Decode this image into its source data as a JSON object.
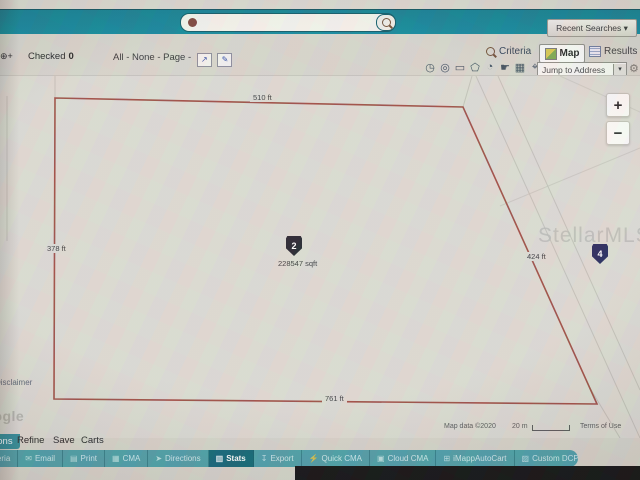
{
  "topbar": {
    "recent_searches_label": "Recent Searches ▾"
  },
  "search": {
    "value": ""
  },
  "toolbar": {
    "left_fragment": "⊕+",
    "checked_label": "Checked",
    "checked_count": "0",
    "select_links": "All - None - Page -",
    "select_icons": [
      "↗",
      "✎"
    ],
    "criteria_label": "Criteria",
    "map_label": "Map",
    "results_label": "Results"
  },
  "map_tools": {
    "glyphs": [
      "◷",
      "◎",
      "▭",
      "⬠",
      "◔",
      "☛",
      "▦",
      "⌖"
    ],
    "jump_label": "Jump to Address"
  },
  "map_type": {
    "fragment": "p"
  },
  "ui": {
    "caret_down": "▾",
    "gear": "⚙"
  },
  "map": {
    "watermark": "StellarMLS",
    "zoom_in": "+",
    "zoom_out": "−",
    "parcel": {
      "top_length": "510 ft",
      "left_length": "378 ft",
      "right_length": "424 ft",
      "bottom_length": "761 ft",
      "marker_number": "2",
      "area": "228547 sqft",
      "marker2_number": "4",
      "outline_color": "#9c4a40"
    },
    "disclaimer": "Disclaimer",
    "logo_partial": "Google",
    "attribution": "Map data ©2020",
    "scale_label": "20 m",
    "terms": "Terms of Use"
  },
  "bottom_tabs": {
    "actions": "Actions",
    "refine": "Refine",
    "save": "Save",
    "carts": "Carts"
  },
  "taskbar": {
    "accent_color": "#4a9da6",
    "active_color": "#0d6273",
    "buttons": [
      {
        "label": "Criteria",
        "icon": "⌕"
      },
      {
        "label": "Email",
        "icon": "✉"
      },
      {
        "label": "Print",
        "icon": "▤"
      },
      {
        "label": "CMA",
        "icon": "▦"
      },
      {
        "label": "Directions",
        "icon": "➤"
      },
      {
        "label": "Stats",
        "icon": "▥"
      },
      {
        "label": "Export",
        "icon": "↧"
      },
      {
        "label": "Quick CMA",
        "icon": "⚡"
      },
      {
        "label": "Cloud CMA",
        "icon": "▣"
      },
      {
        "label": "iMappAutoCart",
        "icon": "⊞"
      },
      {
        "label": "Custom DCP Reports",
        "icon": "▨"
      }
    ]
  }
}
